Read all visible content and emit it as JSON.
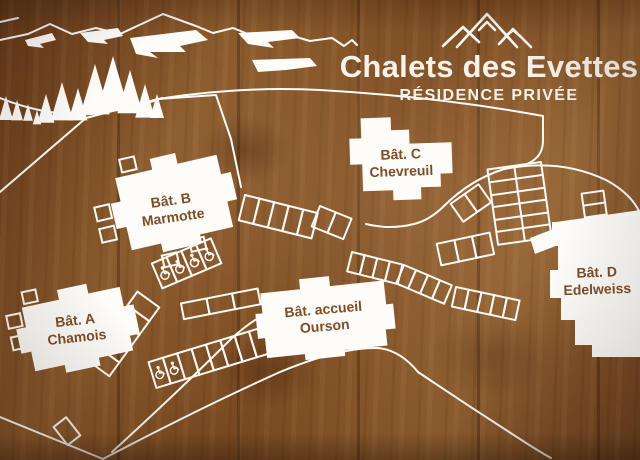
{
  "sign": {
    "title": "Chalets des Evettes",
    "subtitle": "RÉSIDENCE PRIVÉE",
    "logo_icon": "three-peaks-mountain"
  },
  "buildings": [
    {
      "label": "Bât. A",
      "name": "Chamois"
    },
    {
      "label": "Bât. B",
      "name": "Marmotte"
    },
    {
      "label": "Bât. C",
      "name": "Chevreuil"
    },
    {
      "label": "Bât. D",
      "name": "Edelweiss"
    },
    {
      "label": "Bât. accueil",
      "name": "Ourson"
    }
  ],
  "map_features": {
    "icons": [
      "mountains-icon",
      "pine-tree-icon",
      "wheelchair-icon"
    ],
    "accessible_parking_icons_visible": 6
  },
  "colors": {
    "wood": "#7d4c24",
    "wood_dark": "#5e3517",
    "line_white": "#fbfaf7",
    "building_fill": "#fdfcf9",
    "building_text": "#7d4e28",
    "title_text": "#f7f3eb"
  }
}
